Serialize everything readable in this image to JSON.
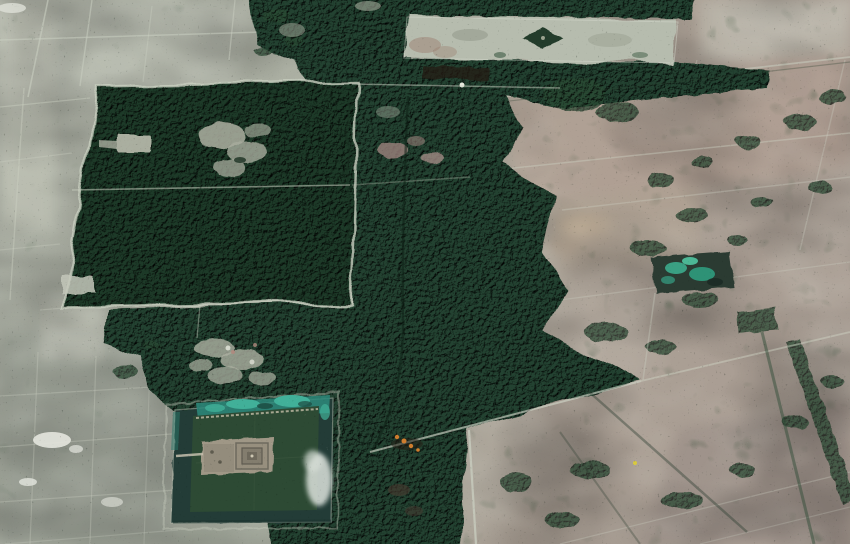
{
  "scene": {
    "view": "oblique-satellite",
    "features": {
      "angkor_thom": {
        "fill": "#1d3a28"
      },
      "central_forest": {
        "fill": "#234231"
      },
      "forest_patches": {
        "fill": "#2a4a34"
      },
      "east_baray": {
        "fill": "#b6bcae"
      },
      "east_mebon": {
        "fill": "#1c3625"
      },
      "angkor_wat_moat": {
        "fill": "#233c37"
      },
      "angkor_wat_island": {
        "fill": "#2d4a34"
      },
      "angkor_wat_temple": {
        "fill": "#9f9786"
      },
      "north_moat_teal": {
        "fill": "#2d8a7b"
      },
      "teal_bright": {
        "fill": "#41b099"
      },
      "srah_srang_pond": {
        "fill": "#2b3b32"
      },
      "light_roads": {
        "stroke": "#ccd1c3"
      },
      "dark_roads": {
        "stroke": "#0f2016"
      },
      "orange_buildings": {
        "fill": "#cf7d2e"
      },
      "yellow_building": {
        "fill": "#d8c93e"
      },
      "clouds": {
        "fill": "#dce2dc"
      },
      "clearings": {
        "fill": "#a8ac9d"
      }
    }
  }
}
